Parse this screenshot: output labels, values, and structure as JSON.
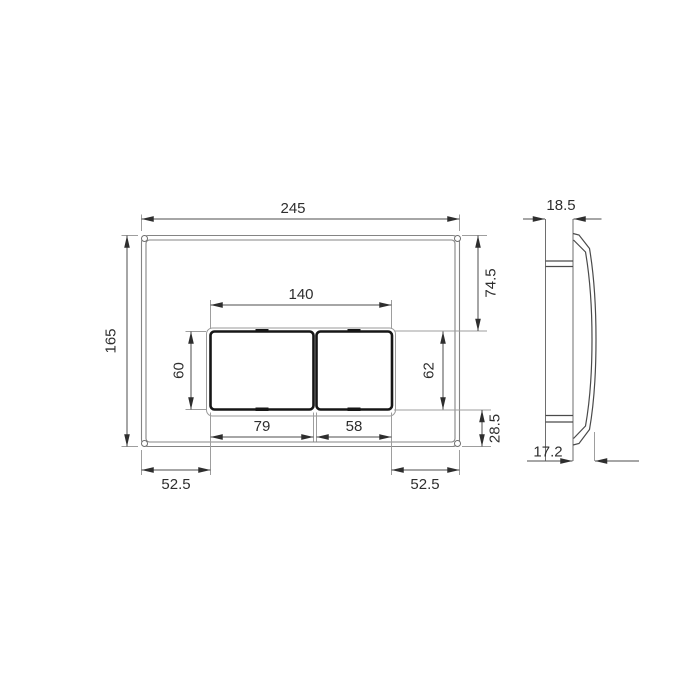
{
  "drawing": {
    "type": "technical-dimension-drawing",
    "subject": "wall flush plate with two buttons, front view and side view"
  },
  "front_view": {
    "overall_width": "245",
    "overall_height": "165",
    "cutout_width": "140",
    "top_to_cutout": "74.5",
    "button_height": "60",
    "cutout_height": "62",
    "big_button_width": "79",
    "small_button_width": "58",
    "cutout_to_bottom": "28.5",
    "bottom_left_offset": "52.5",
    "bottom_right_offset": "52.5"
  },
  "side_view": {
    "total_depth": "18.5",
    "front_protrusion": "17.2"
  },
  "colors": {
    "background": "#ffffff",
    "plate_line": "#848484",
    "button_line": "#161616",
    "dimension_line": "#4d4d4d",
    "extension_line": "#9e9e9e",
    "arrow": "#2e2e2e",
    "text": "#2e2e2e"
  }
}
